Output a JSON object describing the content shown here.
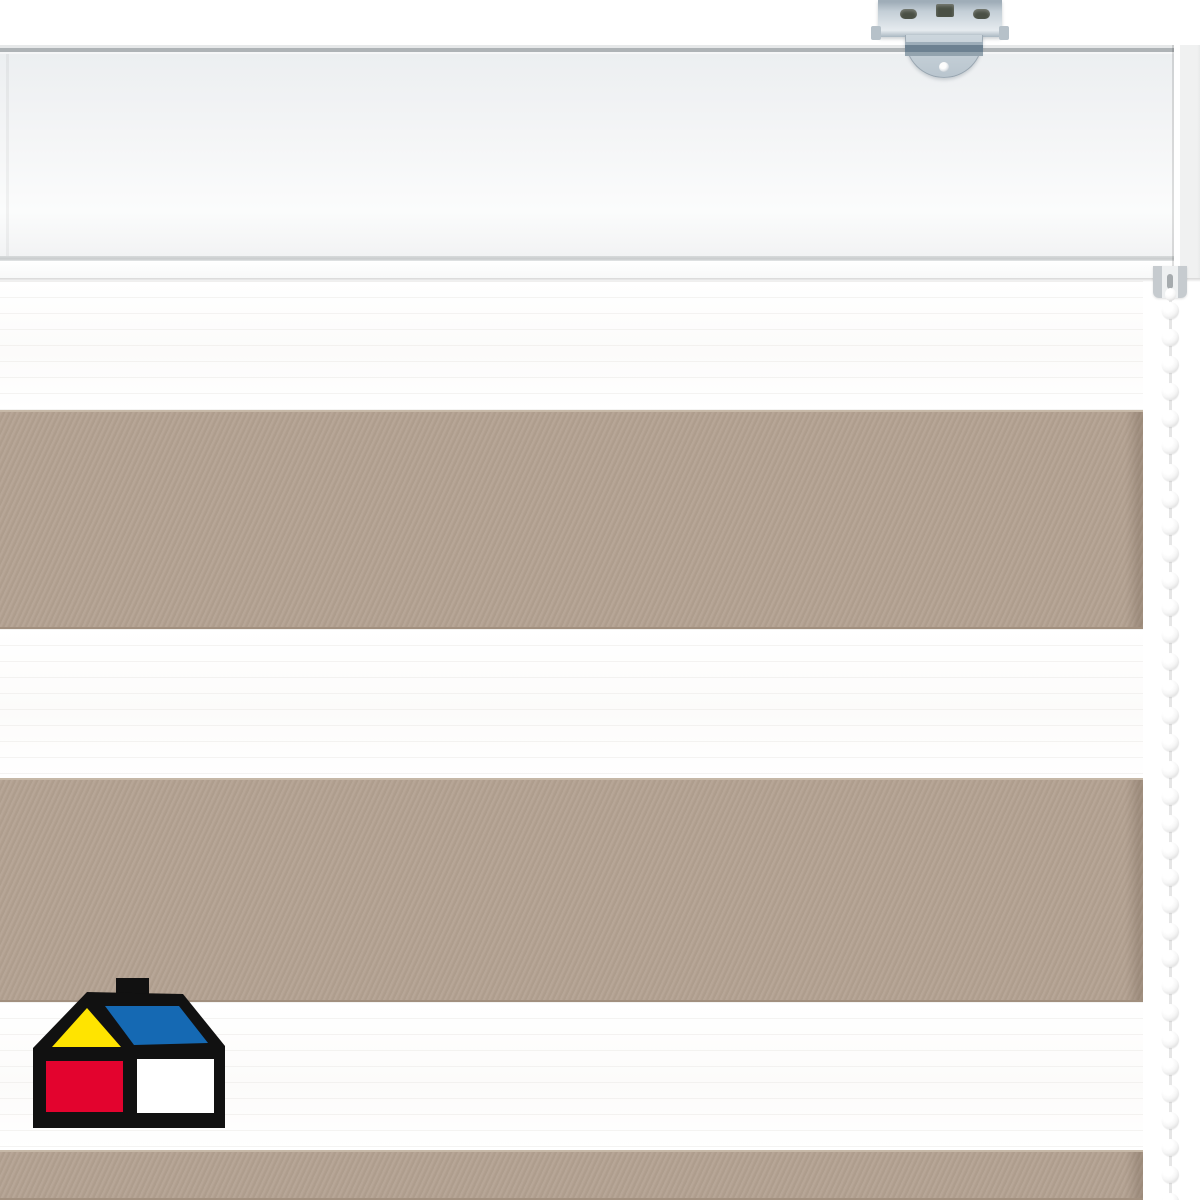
{
  "scene": {
    "description": "Close-up product photo of a day/night zebra roller blind: white cassette headrail with a galvanized metal ceiling bracket at the top right, a white bead pull chain hanging on the right side, and blind fabric with alternating sheer white and taupe horizontal stripes; Homecenter Sodimac house logo watermark in the bottom left corner.",
    "background_color": "#ffffff"
  },
  "headrail": {
    "face_color": "#f4f5f6",
    "top_edge_color": "#aeb3b6",
    "groove_color": "#c9cccd",
    "top_px": 45,
    "bottom_px": 281
  },
  "bracket": {
    "metal_color": "#c3ced6",
    "dark_detail_color": "#6d8191",
    "screw_slot_color": "#4a5045"
  },
  "chain": {
    "bead_color": "#f6f6f6",
    "bead_shadow_color": "#c6c6c6",
    "bead_count": 34,
    "bead_diameter_px": 17,
    "pitch_px": 27,
    "center_x_px": 1170,
    "start_y_px": 302
  },
  "fabric": {
    "top_px": 281,
    "right_edge_px": 1143,
    "white_color": "#ffffff",
    "taupe_color": "#b3a191",
    "taupe_edge_light": "#c6b8a7",
    "taupe_edge_dark": "#a2907f",
    "stripes": [
      {
        "kind": "sheer-white",
        "height_px": 129
      },
      {
        "kind": "taupe",
        "height_px": 219
      },
      {
        "kind": "sheer-white",
        "height_px": 149
      },
      {
        "kind": "taupe",
        "height_px": 224
      },
      {
        "kind": "sheer-white",
        "height_px": 148
      },
      {
        "kind": "taupe",
        "height_px": 50
      }
    ]
  },
  "logo": {
    "name": "homecenter-sodimac-house-logo",
    "outline_color": "#111111",
    "gable_color": "#ffe400",
    "roof_color": "#1569b3",
    "wall_left_color": "#e3032e",
    "wall_right_color": "#ffffff",
    "x_px": 33,
    "y_px": 978,
    "width_px": 192,
    "height_px": 150
  }
}
